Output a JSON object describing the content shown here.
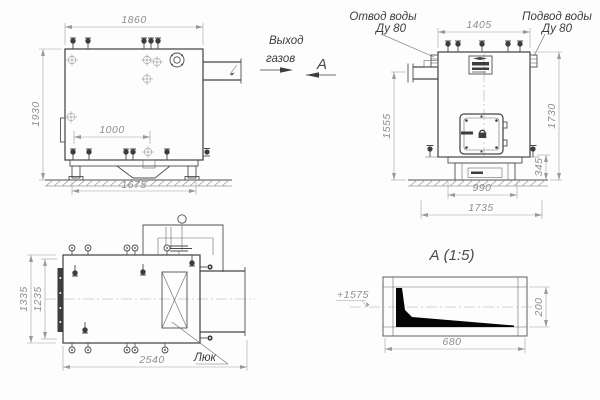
{
  "drawing": {
    "front_view": {
      "dim_width_top": "1860",
      "dim_height_left": "1930",
      "dim_inner": "1000",
      "dim_base": "1675"
    },
    "annotations": {
      "gas_out_line1": "Выход",
      "gas_out_line2": "газов",
      "view_letter": "А"
    },
    "side_view": {
      "label_outlet_line1": "Отвод воды",
      "label_outlet_line2": "Ду 80",
      "label_inlet_line1": "Подвод воды",
      "label_inlet_line2": "Ду 80",
      "dim_top": "1405",
      "dim_left": "1555",
      "dim_right": "1730",
      "dim_base_height": "345",
      "dim_base_inner": "990",
      "dim_base_outer": "1735"
    },
    "top_view": {
      "dim_width_outer": "1335",
      "dim_width_inner": "1235",
      "dim_length": "2540",
      "hatch_label": "Люк"
    },
    "detail_a": {
      "title": "А (1:5)",
      "elevation": "+1575",
      "dim_height": "200",
      "dim_width": "680"
    }
  }
}
